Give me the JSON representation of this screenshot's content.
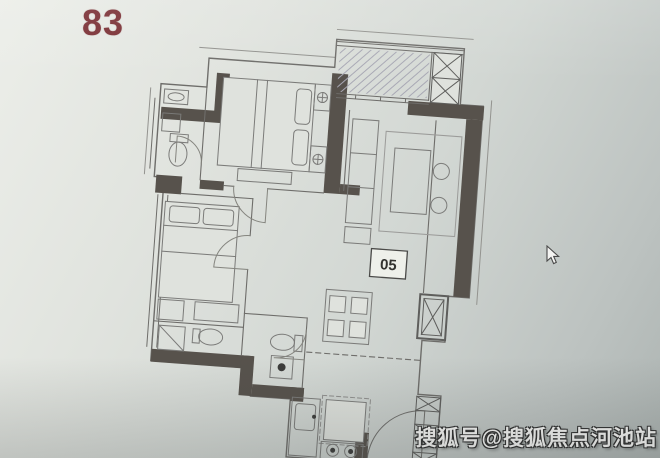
{
  "photo": {
    "background_top": "#eceee9",
    "background_bottom": "#adb4b2"
  },
  "floor_plan": {
    "area_label": "83",
    "area_label_color": "#7b3136",
    "unit_label": "05",
    "wall_color": "#57524c",
    "line_color": "#6e6d6a",
    "features": [
      "balcony",
      "master-bedroom",
      "second-bedroom",
      "living-room",
      "dining-area",
      "kitchen",
      "bathroom-top",
      "bathroom-bottom",
      "entry-door",
      "elevator-shaft",
      "stairs",
      "air-conditioner-platform"
    ]
  },
  "cursor": {
    "x": 548,
    "y": 247
  },
  "watermark": {
    "text": "搜狐号@搜狐焦点河池站"
  }
}
